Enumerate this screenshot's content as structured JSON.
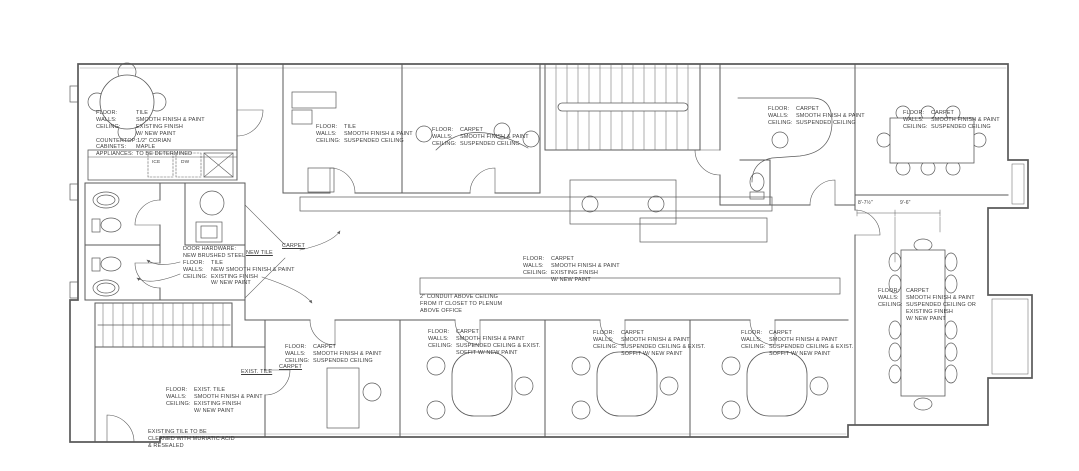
{
  "annotations": {
    "break_room": {
      "rows": [
        {
          "l": "FLOOR:",
          "v": "TILE"
        },
        {
          "l": "WALLS:",
          "v": "SMOOTH FINISH & PAINT"
        },
        {
          "l": "CEILING:",
          "v": "EXISTING FINISH\nW/ NEW PAINT"
        },
        {
          "l": "COUNTERTOP:",
          "v": "1/2\" CORIAN"
        },
        {
          "l": "CABINETS:",
          "v": "MAPLE"
        },
        {
          "l": "APPLIANCES:",
          "v": "TO BE DETERMINED"
        }
      ]
    },
    "office_top_1": {
      "rows": [
        {
          "l": "FLOOR:",
          "v": "TILE"
        },
        {
          "l": "WALLS:",
          "v": "SMOOTH FINISH & PAINT"
        },
        {
          "l": "CEILING:",
          "v": "SUSPENDED CEILING"
        }
      ]
    },
    "office_top_2": {
      "rows": [
        {
          "l": "FLOOR:",
          "v": "CARPET"
        },
        {
          "l": "WALLS:",
          "v": "SMOOTH FINISH & PAINT"
        },
        {
          "l": "CEILING:",
          "v": "SUSPENDED CEILING"
        }
      ]
    },
    "reception": {
      "rows": [
        {
          "l": "FLOOR:",
          "v": "CARPET"
        },
        {
          "l": "WALLS:",
          "v": "SMOOTH FINISH & PAINT"
        },
        {
          "l": "CEILING:",
          "v": "SUSPENDED CEILING"
        }
      ]
    },
    "conference_top": {
      "rows": [
        {
          "l": "FLOOR:",
          "v": "CARPET"
        },
        {
          "l": "WALLS:",
          "v": "SMOOTH FINISH & PAINT"
        },
        {
          "l": "CEILING:",
          "v": "SUSPENDED CEILING"
        }
      ]
    },
    "corridor": {
      "rows": [
        {
          "l": "FLOOR:",
          "v": "CARPET"
        },
        {
          "l": "WALLS:",
          "v": "SMOOTH FINISH & PAINT"
        },
        {
          "l": "CEILING:",
          "v": "EXISTING FINISH\nW/ NEW PAINT"
        }
      ]
    },
    "hall": {
      "rows": [
        {
          "l": "DOOR HARDWARE:",
          "v": ""
        },
        {
          "l": "NEW BRUSHED STEEL",
          "v": ""
        },
        {
          "l": "FLOOR:",
          "v": "TILE"
        },
        {
          "l": "WALLS:",
          "v": "NEW SMOOTH FINISH & PAINT"
        },
        {
          "l": "CEILING:",
          "v": "EXISTING FINISH\nW/ NEW PAINT"
        }
      ]
    },
    "entry": {
      "rows": [
        {
          "l": "FLOOR:",
          "v": "EXIST. TILE"
        },
        {
          "l": "WALLS:",
          "v": "SMOOTH FINISH & PAINT"
        },
        {
          "l": "CEILING:",
          "v": "EXISTING FINISH\nW/ NEW PAINT"
        }
      ]
    },
    "office_bottom_1": {
      "rows": [
        {
          "l": "FLOOR:",
          "v": "CARPET"
        },
        {
          "l": "WALLS:",
          "v": "SMOOTH FINISH & PAINT"
        },
        {
          "l": "CEILING:",
          "v": "SUSPENDED CEILING"
        }
      ]
    },
    "office_bottom_2": {
      "rows": [
        {
          "l": "FLOOR:",
          "v": "CARPET"
        },
        {
          "l": "WALLS:",
          "v": "SMOOTH FINISH & PAINT"
        },
        {
          "l": "CEILING:",
          "v": "SUSPENDED CEILING & EXIST.\nSOFFIT W/ NEW PAINT"
        }
      ]
    },
    "office_bottom_3": {
      "rows": [
        {
          "l": "FLOOR:",
          "v": "CARPET"
        },
        {
          "l": "WALLS:",
          "v": "SMOOTH FINISH & PAINT"
        },
        {
          "l": "CEILING:",
          "v": "SUSPENDED CEILING & EXIST.\nSOFFIT W/ NEW PAINT"
        }
      ]
    },
    "office_bottom_4": {
      "rows": [
        {
          "l": "FLOOR:",
          "v": "CARPET"
        },
        {
          "l": "WALLS:",
          "v": "SMOOTH FINISH & PAINT"
        },
        {
          "l": "CEILING:",
          "v": "SUSPENDED CEILING & EXIST.\nSOFFIT W/ NEW PAINT"
        }
      ]
    },
    "conference_right": {
      "rows": [
        {
          "l": "FLOOR:",
          "v": "CARPET"
        },
        {
          "l": "WALLS:",
          "v": "SMOOTH FINISH & PAINT"
        },
        {
          "l": "CEILING:",
          "v": "SUSPENDED CEILING OR\nEXISTING FINISH\nW/ NEW PAINT"
        }
      ]
    }
  },
  "notes": {
    "conduit": "2\" CONDUIT ABOVE CEILING\nFROM IT CLOSET TO PLENUM\nABOVE OFFICE",
    "muriatic": "EXISTING TILE TO BE\nCLEANED WITH MURIATIC ACID\n& RESEALED"
  },
  "floor_labels": {
    "new_tile": "NEW TILE",
    "carpet_upper": "CARPET",
    "exist_tile": "EXIST. TILE",
    "carpet_lower": "CARPET"
  },
  "appliances": {
    "ice": "ICE",
    "dw": "DW"
  },
  "dimensions": {
    "d1": "8'-7½\"",
    "d2": "9'-6\""
  },
  "colors": {
    "line": "#5a5a5a",
    "text": "#3d3d3d",
    "background": "#ffffff"
  }
}
